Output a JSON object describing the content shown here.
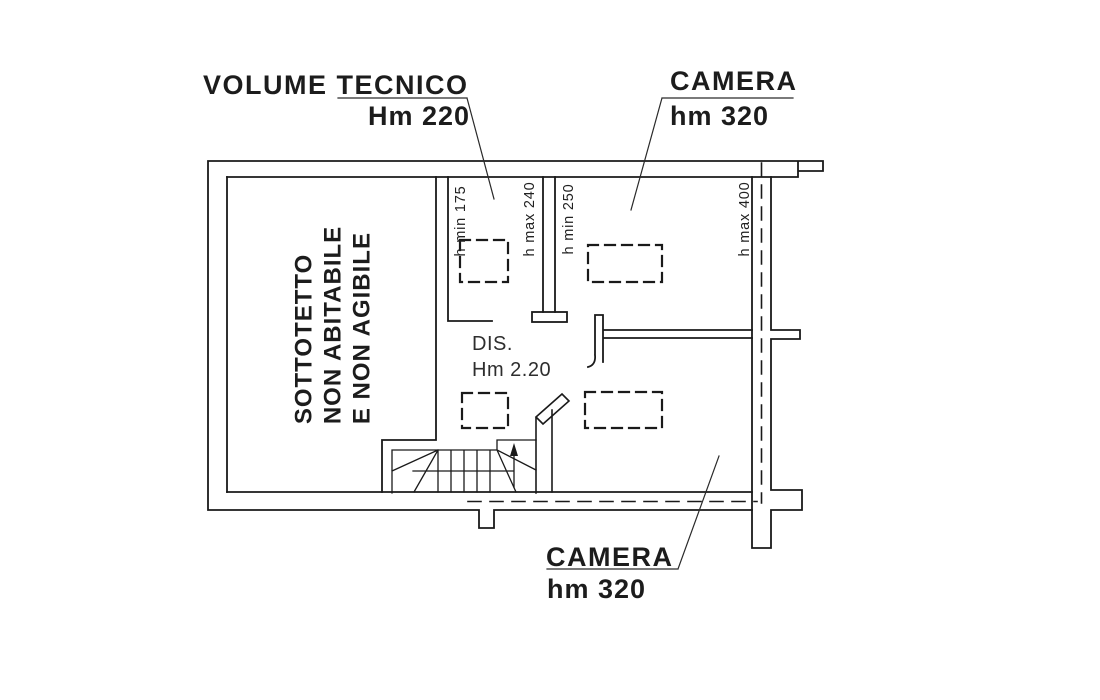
{
  "drawing": {
    "title_hint": "floor plan",
    "background": "#ffffff",
    "line_color": "#1a1a1a",
    "rooms": {
      "sottotetto": {
        "label_lines": [
          "SOTTOTETTO",
          "NON ABITABILE",
          "E NON AGIBILE"
        ]
      },
      "volume_tecnico": {
        "name": "VOLUME TECNICO",
        "height": "Hm 220"
      },
      "camera_top": {
        "name": "CAMERA",
        "height": "hm 320"
      },
      "camera_bottom": {
        "name": "CAMERA",
        "height": "hm 320"
      },
      "dis": {
        "name": "DIS.",
        "height": "Hm 2.20"
      }
    },
    "height_annotations": {
      "h_min_175": "h min 175",
      "h_max_240": "h max 240",
      "h_min_250": "h min 250",
      "h_max_400": "h max 400"
    }
  }
}
